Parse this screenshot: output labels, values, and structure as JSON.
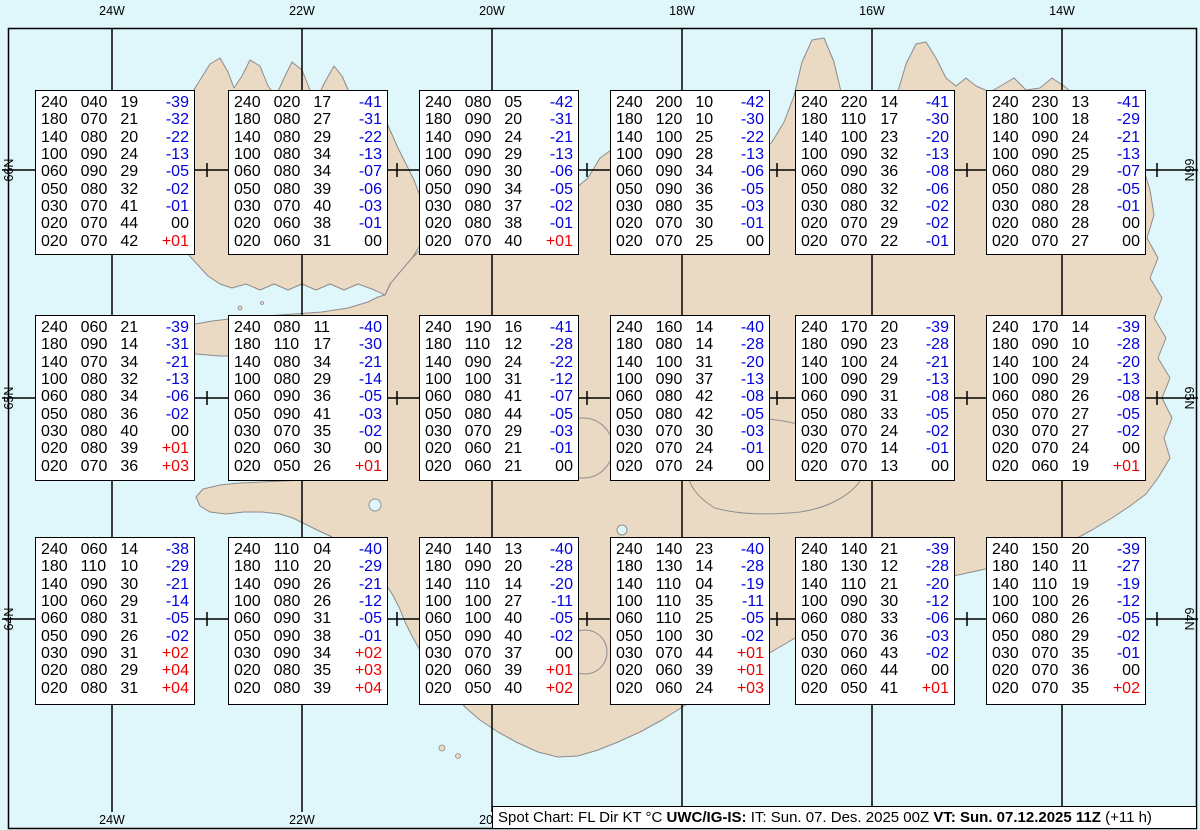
{
  "chart_data": {
    "type": "table",
    "title": "Spot Chart: FL Dir KT °C",
    "columns": [
      "FL",
      "Dir",
      "KT",
      "TempC"
    ],
    "stations": [
      {
        "grid": "r1c1",
        "rows": [
          [
            "240",
            "040",
            "19",
            "-39"
          ],
          [
            "180",
            "070",
            "21",
            "-32"
          ],
          [
            "140",
            "080",
            "20",
            "-22"
          ],
          [
            "100",
            "090",
            "24",
            "-13"
          ],
          [
            "060",
            "090",
            "29",
            "-05"
          ],
          [
            "050",
            "080",
            "32",
            "-02"
          ],
          [
            "030",
            "070",
            "41",
            "-01"
          ],
          [
            "020",
            "070",
            "44",
            "00"
          ],
          [
            "020",
            "070",
            "42",
            "+01"
          ]
        ]
      },
      {
        "grid": "r1c2",
        "rows": [
          [
            "240",
            "020",
            "17",
            "-41"
          ],
          [
            "180",
            "080",
            "27",
            "-31"
          ],
          [
            "140",
            "080",
            "29",
            "-22"
          ],
          [
            "100",
            "080",
            "34",
            "-13"
          ],
          [
            "060",
            "080",
            "34",
            "-07"
          ],
          [
            "050",
            "080",
            "39",
            "-06"
          ],
          [
            "030",
            "070",
            "40",
            "-03"
          ],
          [
            "020",
            "060",
            "38",
            "-01"
          ],
          [
            "020",
            "060",
            "31",
            "00"
          ]
        ]
      },
      {
        "grid": "r1c3",
        "rows": [
          [
            "240",
            "080",
            "05",
            "-42"
          ],
          [
            "180",
            "090",
            "20",
            "-31"
          ],
          [
            "140",
            "090",
            "24",
            "-21"
          ],
          [
            "100",
            "090",
            "29",
            "-13"
          ],
          [
            "060",
            "090",
            "30",
            "-06"
          ],
          [
            "050",
            "090",
            "34",
            "-05"
          ],
          [
            "030",
            "080",
            "37",
            "-02"
          ],
          [
            "020",
            "080",
            "38",
            "-01"
          ],
          [
            "020",
            "070",
            "40",
            "+01"
          ]
        ]
      },
      {
        "grid": "r1c4",
        "rows": [
          [
            "240",
            "200",
            "10",
            "-42"
          ],
          [
            "180",
            "120",
            "10",
            "-30"
          ],
          [
            "140",
            "100",
            "25",
            "-22"
          ],
          [
            "100",
            "090",
            "28",
            "-13"
          ],
          [
            "060",
            "090",
            "34",
            "-06"
          ],
          [
            "050",
            "090",
            "36",
            "-05"
          ],
          [
            "030",
            "080",
            "35",
            "-03"
          ],
          [
            "020",
            "070",
            "30",
            "-01"
          ],
          [
            "020",
            "070",
            "25",
            "00"
          ]
        ]
      },
      {
        "grid": "r1c5",
        "rows": [
          [
            "240",
            "220",
            "14",
            "-41"
          ],
          [
            "180",
            "110",
            "17",
            "-30"
          ],
          [
            "140",
            "100",
            "23",
            "-20"
          ],
          [
            "100",
            "090",
            "32",
            "-13"
          ],
          [
            "060",
            "090",
            "36",
            "-08"
          ],
          [
            "050",
            "080",
            "32",
            "-06"
          ],
          [
            "030",
            "080",
            "32",
            "-02"
          ],
          [
            "020",
            "070",
            "29",
            "-02"
          ],
          [
            "020",
            "070",
            "22",
            "-01"
          ]
        ]
      },
      {
        "grid": "r1c6",
        "rows": [
          [
            "240",
            "230",
            "13",
            "-41"
          ],
          [
            "180",
            "100",
            "18",
            "-29"
          ],
          [
            "140",
            "090",
            "24",
            "-21"
          ],
          [
            "100",
            "090",
            "25",
            "-13"
          ],
          [
            "060",
            "080",
            "29",
            "-07"
          ],
          [
            "050",
            "080",
            "28",
            "-05"
          ],
          [
            "030",
            "080",
            "28",
            "-01"
          ],
          [
            "020",
            "080",
            "28",
            "00"
          ],
          [
            "020",
            "070",
            "27",
            "00"
          ]
        ]
      },
      {
        "grid": "r2c1",
        "rows": [
          [
            "240",
            "060",
            "21",
            "-39"
          ],
          [
            "180",
            "090",
            "14",
            "-31"
          ],
          [
            "140",
            "070",
            "34",
            "-21"
          ],
          [
            "100",
            "080",
            "32",
            "-13"
          ],
          [
            "060",
            "080",
            "34",
            "-06"
          ],
          [
            "050",
            "080",
            "36",
            "-02"
          ],
          [
            "030",
            "080",
            "40",
            "00"
          ],
          [
            "020",
            "080",
            "39",
            "+01"
          ],
          [
            "020",
            "070",
            "36",
            "+03"
          ]
        ]
      },
      {
        "grid": "r2c2",
        "rows": [
          [
            "240",
            "080",
            "11",
            "-40"
          ],
          [
            "180",
            "110",
            "17",
            "-30"
          ],
          [
            "140",
            "080",
            "34",
            "-21"
          ],
          [
            "100",
            "080",
            "29",
            "-14"
          ],
          [
            "060",
            "090",
            "36",
            "-05"
          ],
          [
            "050",
            "090",
            "41",
            "-03"
          ],
          [
            "030",
            "070",
            "35",
            "-02"
          ],
          [
            "020",
            "060",
            "30",
            "00"
          ],
          [
            "020",
            "050",
            "26",
            "+01"
          ]
        ]
      },
      {
        "grid": "r2c3",
        "rows": [
          [
            "240",
            "190",
            "16",
            "-41"
          ],
          [
            "180",
            "110",
            "12",
            "-28"
          ],
          [
            "140",
            "090",
            "24",
            "-22"
          ],
          [
            "100",
            "100",
            "31",
            "-12"
          ],
          [
            "060",
            "080",
            "41",
            "-07"
          ],
          [
            "050",
            "080",
            "44",
            "-05"
          ],
          [
            "030",
            "070",
            "29",
            "-03"
          ],
          [
            "020",
            "060",
            "21",
            "-01"
          ],
          [
            "020",
            "060",
            "21",
            "00"
          ]
        ]
      },
      {
        "grid": "r2c4",
        "rows": [
          [
            "240",
            "160",
            "14",
            "-40"
          ],
          [
            "180",
            "080",
            "14",
            "-28"
          ],
          [
            "140",
            "100",
            "31",
            "-20"
          ],
          [
            "100",
            "090",
            "37",
            "-13"
          ],
          [
            "060",
            "080",
            "42",
            "-08"
          ],
          [
            "050",
            "080",
            "42",
            "-05"
          ],
          [
            "030",
            "070",
            "30",
            "-03"
          ],
          [
            "020",
            "070",
            "24",
            "-01"
          ],
          [
            "020",
            "070",
            "24",
            "00"
          ]
        ]
      },
      {
        "grid": "r2c5",
        "rows": [
          [
            "240",
            "170",
            "20",
            "-39"
          ],
          [
            "180",
            "090",
            "23",
            "-28"
          ],
          [
            "140",
            "100",
            "24",
            "-21"
          ],
          [
            "100",
            "090",
            "29",
            "-13"
          ],
          [
            "060",
            "090",
            "31",
            "-08"
          ],
          [
            "050",
            "080",
            "33",
            "-05"
          ],
          [
            "030",
            "070",
            "24",
            "-02"
          ],
          [
            "020",
            "070",
            "14",
            "-01"
          ],
          [
            "020",
            "070",
            "13",
            "00"
          ]
        ]
      },
      {
        "grid": "r2c6",
        "rows": [
          [
            "240",
            "170",
            "14",
            "-39"
          ],
          [
            "180",
            "090",
            "10",
            "-28"
          ],
          [
            "140",
            "100",
            "24",
            "-20"
          ],
          [
            "100",
            "090",
            "29",
            "-13"
          ],
          [
            "060",
            "080",
            "26",
            "-08"
          ],
          [
            "050",
            "070",
            "27",
            "-05"
          ],
          [
            "030",
            "070",
            "27",
            "-02"
          ],
          [
            "020",
            "070",
            "24",
            "00"
          ],
          [
            "020",
            "060",
            "19",
            "+01"
          ]
        ]
      },
      {
        "grid": "r3c1",
        "rows": [
          [
            "240",
            "060",
            "14",
            "-38"
          ],
          [
            "180",
            "110",
            "10",
            "-29"
          ],
          [
            "140",
            "090",
            "30",
            "-21"
          ],
          [
            "100",
            "060",
            "29",
            "-14"
          ],
          [
            "060",
            "080",
            "31",
            "-05"
          ],
          [
            "050",
            "090",
            "26",
            "-02"
          ],
          [
            "030",
            "090",
            "31",
            "+02"
          ],
          [
            "020",
            "080",
            "29",
            "+04"
          ],
          [
            "020",
            "080",
            "31",
            "+04"
          ]
        ]
      },
      {
        "grid": "r3c2",
        "rows": [
          [
            "240",
            "110",
            "04",
            "-40"
          ],
          [
            "180",
            "110",
            "20",
            "-29"
          ],
          [
            "140",
            "090",
            "26",
            "-21"
          ],
          [
            "100",
            "080",
            "26",
            "-12"
          ],
          [
            "060",
            "090",
            "31",
            "-05"
          ],
          [
            "050",
            "090",
            "38",
            "-01"
          ],
          [
            "030",
            "090",
            "34",
            "+02"
          ],
          [
            "020",
            "080",
            "35",
            "+03"
          ],
          [
            "020",
            "080",
            "39",
            "+04"
          ]
        ]
      },
      {
        "grid": "r3c3",
        "rows": [
          [
            "240",
            "140",
            "13",
            "-40"
          ],
          [
            "180",
            "090",
            "20",
            "-28"
          ],
          [
            "140",
            "110",
            "14",
            "-20"
          ],
          [
            "100",
            "100",
            "27",
            "-11"
          ],
          [
            "060",
            "100",
            "40",
            "-05"
          ],
          [
            "050",
            "090",
            "40",
            "-02"
          ],
          [
            "030",
            "070",
            "37",
            "00"
          ],
          [
            "020",
            "060",
            "39",
            "+01"
          ],
          [
            "020",
            "050",
            "40",
            "+02"
          ]
        ]
      },
      {
        "grid": "r3c4",
        "rows": [
          [
            "240",
            "140",
            "23",
            "-40"
          ],
          [
            "180",
            "130",
            "14",
            "-28"
          ],
          [
            "140",
            "110",
            "04",
            "-19"
          ],
          [
            "100",
            "110",
            "35",
            "-11"
          ],
          [
            "060",
            "110",
            "25",
            "-05"
          ],
          [
            "050",
            "100",
            "30",
            "-02"
          ],
          [
            "030",
            "070",
            "44",
            "+01"
          ],
          [
            "020",
            "060",
            "39",
            "+01"
          ],
          [
            "020",
            "060",
            "24",
            "+03"
          ]
        ]
      },
      {
        "grid": "r3c5",
        "rows": [
          [
            "240",
            "140",
            "21",
            "-39"
          ],
          [
            "180",
            "130",
            "12",
            "-28"
          ],
          [
            "140",
            "110",
            "21",
            "-20"
          ],
          [
            "100",
            "090",
            "30",
            "-12"
          ],
          [
            "060",
            "080",
            "33",
            "-06"
          ],
          [
            "050",
            "070",
            "36",
            "-03"
          ],
          [
            "030",
            "060",
            "43",
            "-02"
          ],
          [
            "020",
            "060",
            "44",
            "00"
          ],
          [
            "020",
            "050",
            "41",
            "+01"
          ]
        ]
      },
      {
        "grid": "r3c6",
        "rows": [
          [
            "240",
            "150",
            "20",
            "-39"
          ],
          [
            "180",
            "140",
            "11",
            "-27"
          ],
          [
            "140",
            "110",
            "19",
            "-19"
          ],
          [
            "100",
            "100",
            "26",
            "-12"
          ],
          [
            "060",
            "080",
            "26",
            "-05"
          ],
          [
            "050",
            "080",
            "29",
            "-02"
          ],
          [
            "030",
            "070",
            "35",
            "-01"
          ],
          [
            "020",
            "070",
            "36",
            "00"
          ],
          [
            "020",
            "070",
            "35",
            "+02"
          ]
        ]
      }
    ]
  },
  "map": {
    "meridians": [
      {
        "label": "24W",
        "x": 112
      },
      {
        "label": "22W",
        "x": 302
      },
      {
        "label": "20W",
        "x": 492
      },
      {
        "label": "18W",
        "x": 682
      },
      {
        "label": "16W",
        "x": 872
      },
      {
        "label": "14W",
        "x": 1062
      }
    ],
    "parallels": [
      {
        "label": "66N",
        "y": 170
      },
      {
        "label": "65N",
        "y": 398
      },
      {
        "label": "64N",
        "y": 619
      }
    ],
    "colors": {
      "sea": "#dff6fb",
      "land": "#ead9c3",
      "coast": "#8c8c8c",
      "grid": "#000000",
      "temp_negative": "#0000dd",
      "temp_positive": "#ee0000",
      "temp_zero": "#000000"
    }
  },
  "footer": {
    "text_plain_1": "Spot Chart: FL Dir KT °C ",
    "text_bold_1": "UWC/IG-IS:",
    "text_plain_2": " IT: Sun. 07. Des. 2025 00Z ",
    "text_bold_2": "VT: Sun. 07.12.2025 11Z",
    "text_plain_3": " (+11 h)"
  }
}
